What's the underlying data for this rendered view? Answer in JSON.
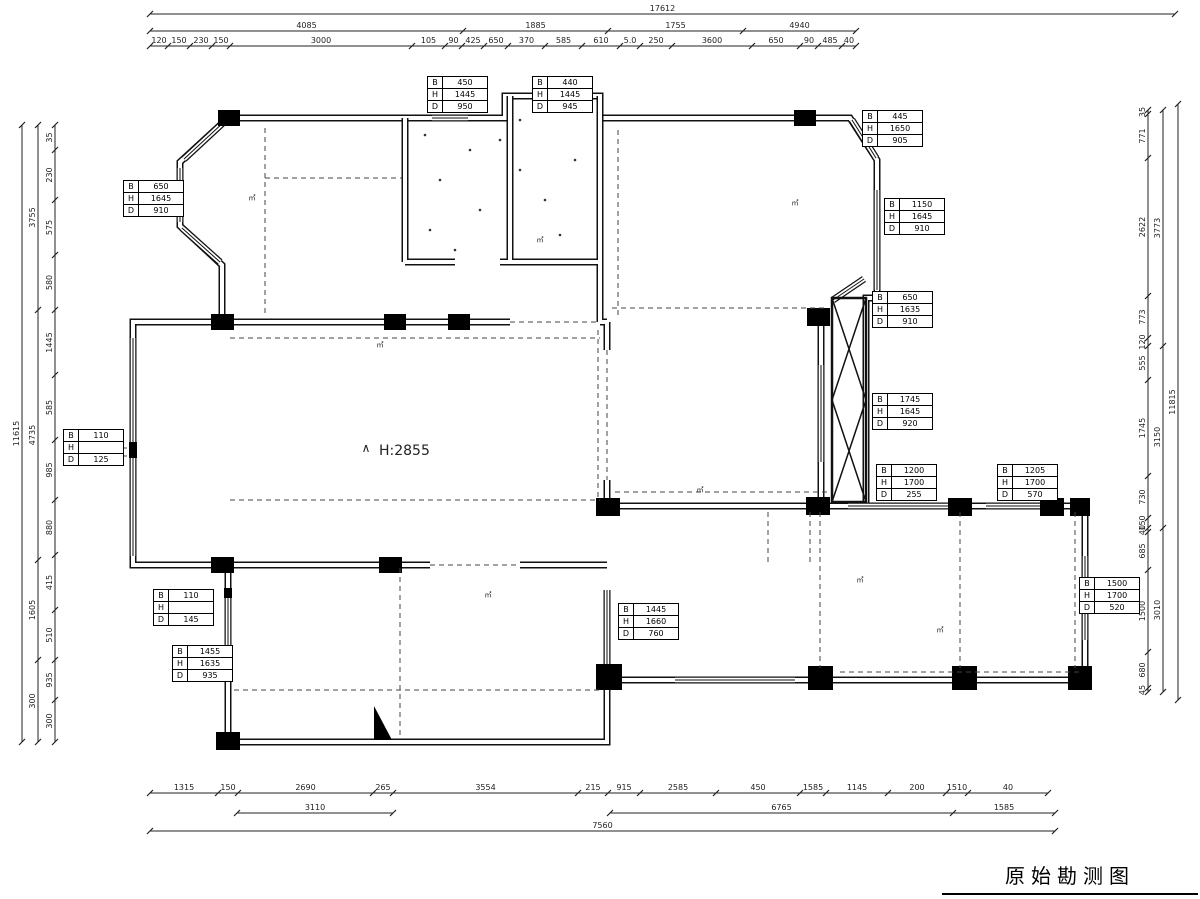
{
  "title": {
    "label_cn": "原始勘测图"
  },
  "center_label": {
    "symbol": "∧",
    "text": "H:2855"
  },
  "table_labels": [
    "B",
    "H",
    "D"
  ],
  "tables": [
    {
      "B": "450",
      "H": "1445",
      "D": "950"
    },
    {
      "B": "440",
      "H": "1445",
      "D": "945"
    },
    {
      "B": "650",
      "H": "1645",
      "D": "910"
    },
    {
      "B": "445",
      "H": "1650",
      "D": "905"
    },
    {
      "B": "1150",
      "H": "1645",
      "D": "910"
    },
    {
      "B": "650",
      "H": "1635",
      "D": "910"
    },
    {
      "B": "1745",
      "H": "1645",
      "D": "920"
    },
    {
      "B": "1200",
      "H": "1700",
      "D": "255"
    },
    {
      "B": "1205",
      "H": "1700",
      "D": "570"
    },
    {
      "B": "110",
      "H": "",
      "D": "125"
    },
    {
      "B": "110",
      "H": "",
      "D": "145"
    },
    {
      "B": "1455",
      "H": "1635",
      "D": "935"
    },
    {
      "B": "1445",
      "H": "1660",
      "D": "760"
    },
    {
      "B": "1500",
      "H": "1700",
      "D": "520"
    }
  ],
  "dims": {
    "top": {
      "total": "17612",
      "groups": [
        "4085",
        "1885",
        "1755",
        "4940"
      ],
      "detail": [
        "120",
        "150",
        "230",
        "150",
        "3000",
        "105",
        "90",
        "425",
        "650",
        "370",
        "585",
        "610",
        "5.0",
        "250",
        "3600",
        "650",
        "90",
        "485",
        "40"
      ]
    },
    "bottom": {
      "row1": [
        "1315",
        "150",
        "2690",
        "265",
        "3554",
        "215",
        "915",
        "2585",
        "450",
        "1585",
        "1145",
        "200",
        "1510",
        "40"
      ],
      "row2a": [
        "3110"
      ],
      "row2b": [
        "6765",
        "1585"
      ],
      "total": "7560"
    },
    "left": {
      "total": "11615",
      "groups": [
        "3755",
        "4735",
        "1605",
        "300"
      ],
      "detail": [
        "35",
        "230",
        "575",
        "580",
        "1445",
        "585",
        "985",
        "880",
        "415",
        "510",
        "935",
        "300"
      ]
    },
    "right": {
      "total": "11815",
      "groups": [
        "3773",
        "3150",
        "3010"
      ],
      "detail": [
        "35",
        "771",
        "2622",
        "773",
        "120",
        "555",
        "1745",
        "730",
        "150",
        "40",
        "685",
        "1500",
        "680",
        "45"
      ]
    }
  },
  "room_marks": [
    "㎡",
    "㎡",
    "㎡",
    "㎡",
    "㎡",
    "㎡",
    "㎡",
    "㎡"
  ]
}
